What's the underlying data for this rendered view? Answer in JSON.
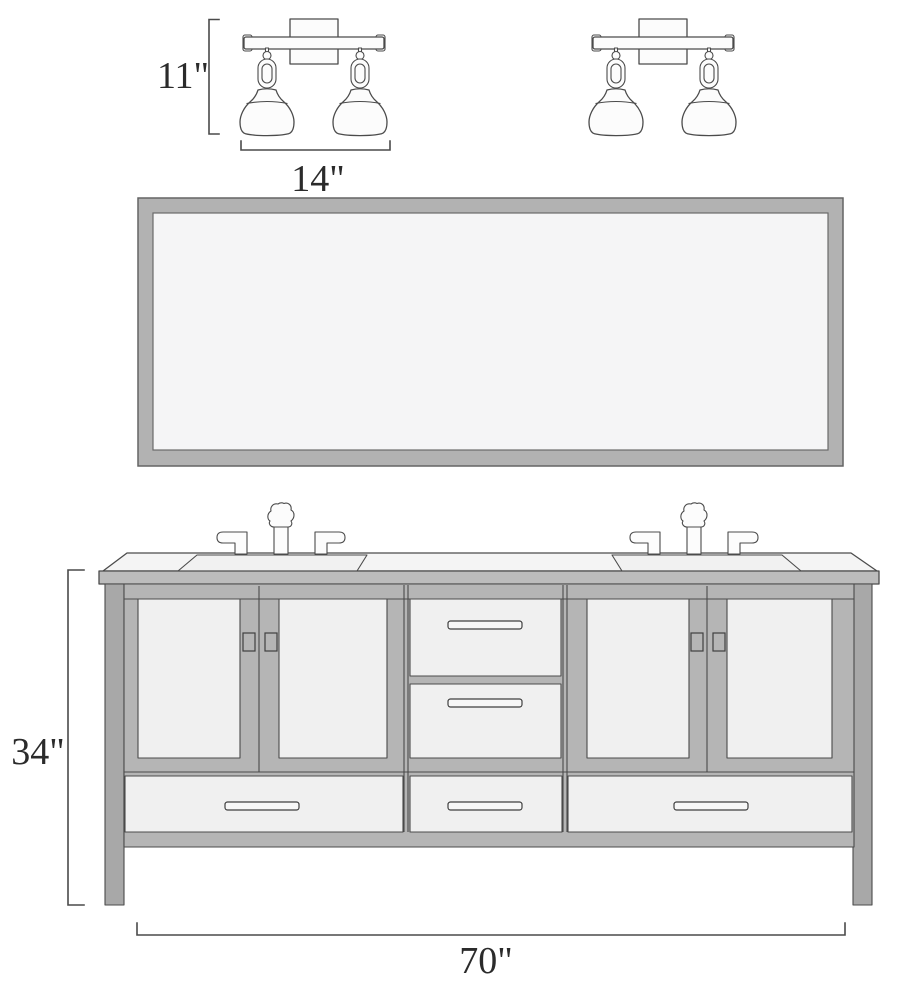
{
  "figure": {
    "kind": "bathroom double vanity technical elevation drawing",
    "background": "#ffffff"
  },
  "dimensions": {
    "fixture_height": "11\"",
    "fixture_width": "14\"",
    "vanity_height": "34\"",
    "vanity_width": "70\""
  },
  "components": {
    "left_fixture": "two-light vanity wall sconce",
    "right_fixture": "two-light vanity wall sconce",
    "mirror": "framed rectangular mirror",
    "vanity": "double-sink vanity cabinet",
    "left_sink": "rectangular undermount sink with two-handle faucet",
    "right_sink": "rectangular undermount sink with two-handle faucet",
    "door_count": 4,
    "upper_drawer_count": 2,
    "bottom_drawer_count": 3
  },
  "colors": {
    "outline": "#4b4b4b",
    "frame_gray": "#b5b5b5",
    "leg_gray": "#a8a8a8",
    "panel_white": "#f0f0f0",
    "counter_top": "#f4f4f4",
    "counter_edge": "#bcbcbc",
    "mirror_frame": "#b2b2b2",
    "mirror_glass": "#f5f5f6",
    "fixture_fill": "#fcfcfc"
  }
}
